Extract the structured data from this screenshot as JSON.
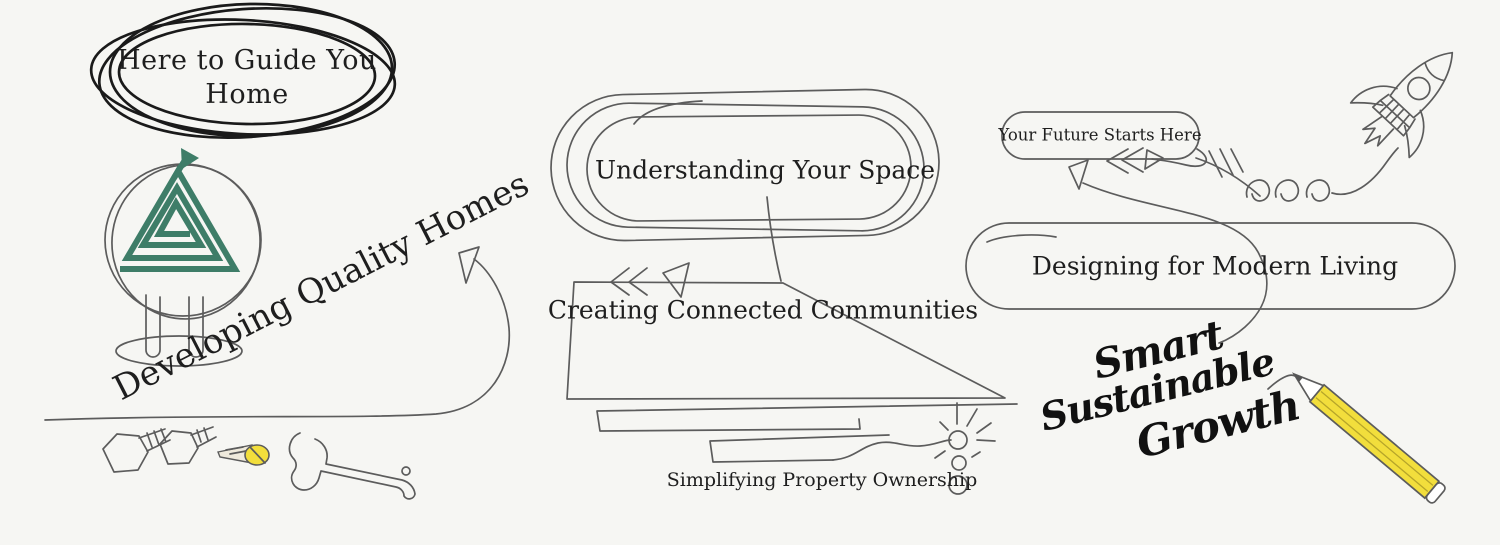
{
  "colors": {
    "background": "#f6f6f3",
    "ink": "#5c5c5c",
    "dark-ink": "#1a1a1a",
    "text": "#1e1e1e",
    "logo-green": "#3e7d68",
    "accent-yellow": "#f2de3c"
  },
  "hero_badge": {
    "line1": "Here to Guide You",
    "line2": "Home"
  },
  "labels": {
    "developing": "Developing Quality Homes",
    "understanding": "Understanding Your Space",
    "creating": "Creating Connected Communities",
    "simplifying": "Simplifying Property Ownership",
    "future": "Your Future Starts Here",
    "designing": "Designing for Modern Living"
  },
  "handwriting": {
    "line1": "Smart",
    "line2": "Sustainable",
    "line3": "Growth"
  },
  "icons": {
    "logo": "triangle-spiral-logo",
    "rocket": "rocket-doodle",
    "pencil": "pencil-doodle",
    "wrench": "wrench-icon",
    "bolt": "hex-bolt-icon",
    "screw": "screw-icon",
    "sparkle": "sparkle-doodle",
    "arrows": "sketch-arrow-doodles"
  }
}
